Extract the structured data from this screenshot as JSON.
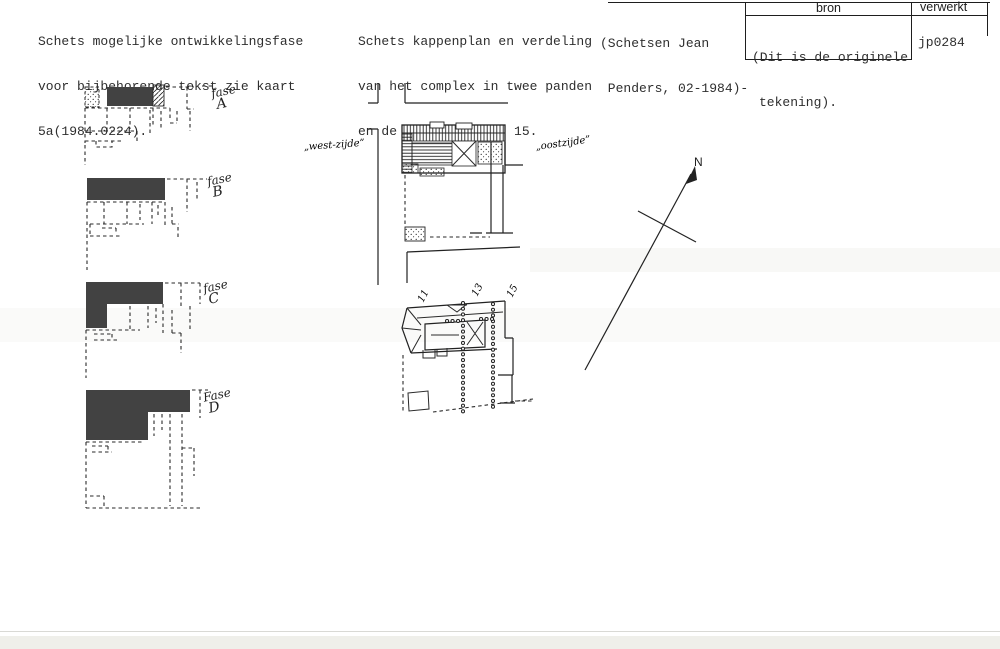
{
  "notes": {
    "left": {
      "line1": "Schets mogelijke ontwikkelingsfase",
      "line2": "voor bijbehorende tekst zie kaart",
      "line3": "5a(1984.0224)."
    },
    "middle": {
      "line1": "Schets kappenplan en verdeling",
      "line2": "van het complex in twee panden",
      "line3": "en de grens met nr. 15."
    },
    "credit": {
      "line1": "(Schetsen Jean",
      "line2": " Penders, 02-1984)-"
    }
  },
  "table": {
    "header_bron": "bron",
    "header_verwerkt": "verwerkt",
    "bron_line1": "(Dit is de originele",
    "bron_line2": "tekening).",
    "verwerkt_value": "jp0284"
  },
  "phases": {
    "a": {
      "word": "fase",
      "letter": "A"
    },
    "b": {
      "word": "fase",
      "letter": "B"
    },
    "c": {
      "word": "fase",
      "letter": "C"
    },
    "d": {
      "word": "Fase",
      "letter": "D"
    }
  },
  "site_plan": {
    "west_label": "„west-zijde”",
    "east_label": "„oostzijde”"
  },
  "roof_plan": {
    "n11": "11",
    "n13": "13",
    "n15": "15"
  },
  "compass": {
    "north_label": "N"
  },
  "colors": {
    "ink": "#1f1f1f",
    "dark_fill": "#424242",
    "paper": "#ffffff"
  }
}
